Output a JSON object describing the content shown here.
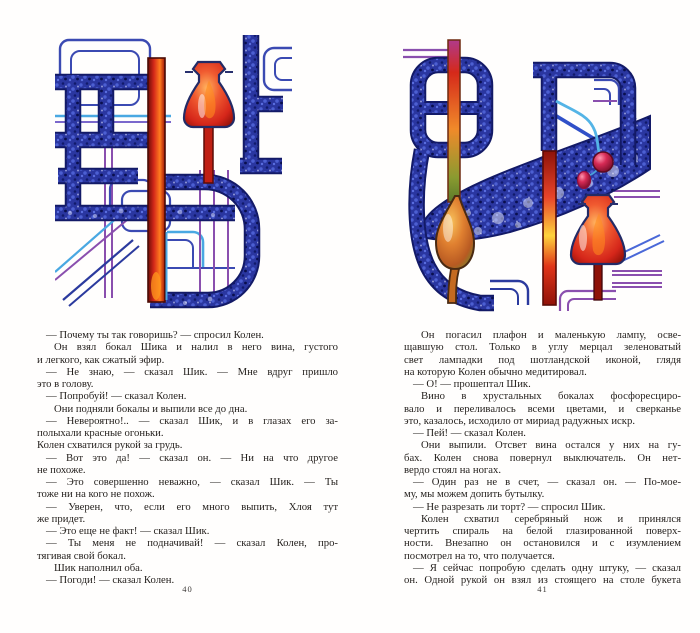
{
  "pages": [
    {
      "number": "40",
      "lines": [
        {
          "t": "— Почему ты так говоришь? —  спросил Колен.",
          "i": 1,
          "j": false
        },
        {
          "t": "Он взял бокал Шика и налил в него вина, густого",
          "i": 2,
          "j": true
        },
        {
          "t": "и легкого, как сжатый эфир.",
          "i": 0,
          "j": false
        },
        {
          "t": "— Не знаю, —  сказал Шик. —  Мне вдруг пришло",
          "i": 1,
          "j": true
        },
        {
          "t": "это в голову.",
          "i": 0,
          "j": false
        },
        {
          "t": "— Попробуй! —  сказал Колен.",
          "i": 1,
          "j": false
        },
        {
          "t": "Они подняли бокалы и выпили все до дна.",
          "i": 2,
          "j": false
        },
        {
          "t": "— Невероятно!.. —  сказал Шик, и в глазах его за-",
          "i": 1,
          "j": true
        },
        {
          "t": "полыхали красные огоньки.",
          "i": 0,
          "j": false
        },
        {
          "t": "Колен схватился рукой за грудь.",
          "i": 0,
          "j": false
        },
        {
          "t": "— Вот это да! —  сказал он. —  Ни на что другое",
          "i": 1,
          "j": true
        },
        {
          "t": "не похоже.",
          "i": 0,
          "j": false
        },
        {
          "t": "— Это совершенно неважно, —  сказал Шик. —  Ты",
          "i": 1,
          "j": true
        },
        {
          "t": "тоже ни на кого не похож.",
          "i": 0,
          "j": false
        },
        {
          "t": "— Уверен, что, если его много выпить, Хлоя тут",
          "i": 1,
          "j": true
        },
        {
          "t": "же придет.",
          "i": 0,
          "j": false
        },
        {
          "t": "— Это еще не факт! —  сказал Шик.",
          "i": 1,
          "j": false
        },
        {
          "t": "— Ты меня не подначивай! —  сказал Колен, про-",
          "i": 1,
          "j": true
        },
        {
          "t": "тягивая свой бокал.",
          "i": 0,
          "j": false
        },
        {
          "t": "Шик наполнил оба.",
          "i": 2,
          "j": false
        },
        {
          "t": "— Погоди! —  сказал Колен.",
          "i": 1,
          "j": false
        }
      ]
    },
    {
      "number": "41",
      "lines": [
        {
          "t": "Он погасил плафон и маленькую лампу, осве-",
          "i": 2,
          "j": true
        },
        {
          "t": "щавшую стол. Только в углу мерцал зеленоватый",
          "i": 0,
          "j": true
        },
        {
          "t": "свет лампадки под шотландской иконой, глядя",
          "i": 0,
          "j": true
        },
        {
          "t": "на которую Колен обычно медитировал.",
          "i": 0,
          "j": false
        },
        {
          "t": "— О! —  прошептал Шик.",
          "i": 1,
          "j": false
        },
        {
          "t": "Вино в хрустальных бокалах фосфоресциро-",
          "i": 2,
          "j": true
        },
        {
          "t": "вало и переливалось всеми цветами, и сверканье",
          "i": 0,
          "j": true
        },
        {
          "t": "это, казалось, исходило от мириад радужных искр.",
          "i": 0,
          "j": false
        },
        {
          "t": "— Пей! —  сказал Колен.",
          "i": 1,
          "j": false
        },
        {
          "t": "Они выпили. Отсвет вина остался у них на гу-",
          "i": 2,
          "j": true
        },
        {
          "t": "бах. Колен снова повернул выключатель. Он нет-",
          "i": 0,
          "j": true
        },
        {
          "t": "вердо стоял на ногах.",
          "i": 0,
          "j": false
        },
        {
          "t": "— Один раз не в счет, —  сказал он. —  По-мое-",
          "i": 1,
          "j": true
        },
        {
          "t": "му, мы можем допить бутылку.",
          "i": 0,
          "j": false
        },
        {
          "t": "— Не разрезать ли торт? —  спросил Шик.",
          "i": 1,
          "j": false
        },
        {
          "t": "Колен схватил серебряный нож и принялся",
          "i": 2,
          "j": true
        },
        {
          "t": "чертить спираль на белой глазированной поверх-",
          "i": 0,
          "j": true
        },
        {
          "t": "ности. Внезапно он остановился и с изумлением",
          "i": 0,
          "j": true
        },
        {
          "t": "посмотрел на то, что получается.",
          "i": 0,
          "j": false
        },
        {
          "t": "— Я сейчас попробую сделать одну штуку, —  сказал",
          "i": 1,
          "j": true
        },
        {
          "t": "он. Одной рукой он взял из стоящего на столе букета",
          "i": 0,
          "j": true
        }
      ]
    }
  ],
  "illustrations": {
    "left": {
      "description": "Ink-and-watercolor maze of thick speckled navy pipes, thin blue, cyan and purple conduits, a bright red vertical pipe and a red Erlenmeyer flask on a red stem"
    },
    "right": {
      "description": "Navy pipework with bubbly funnel trough, amber retort bulb on an orange pipe, red column, red Erlenmeyer flask with a cherry-like dropper, purple and blue thin pipes"
    },
    "palette": {
      "navy": "#2a36a0",
      "navy_dark": "#131a67",
      "thin_blue": "#3b4ab2",
      "cyan": "#49a8e2",
      "purple": "#8a4fae",
      "red": "#d5291a",
      "orange": "#ff7d1e",
      "amber": "#d4812a",
      "text": "#231f1c"
    }
  }
}
